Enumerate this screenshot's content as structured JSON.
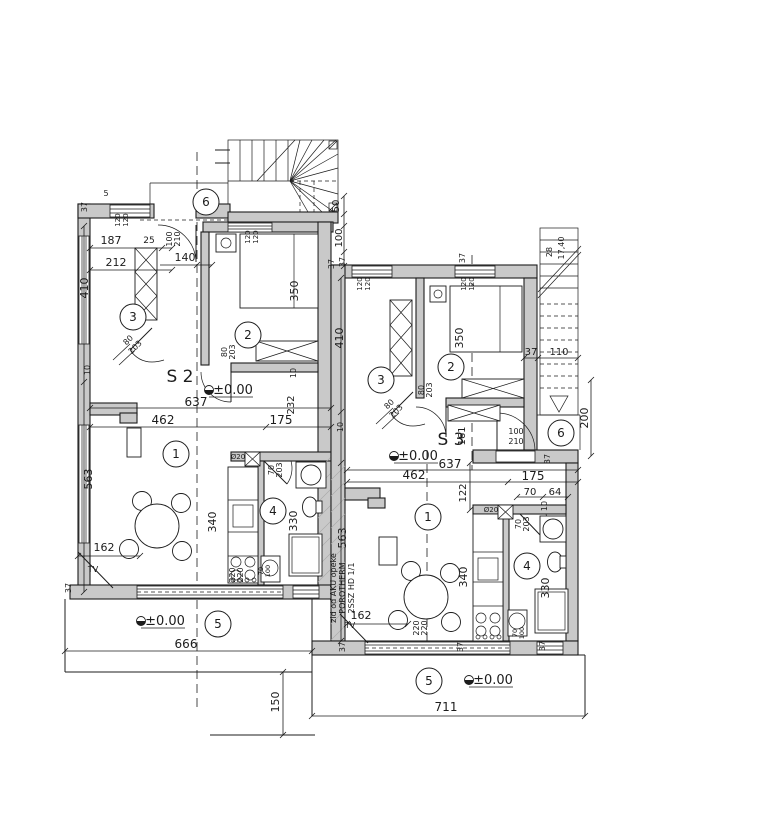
{
  "drawing": {
    "units": {
      "left": "S 2",
      "right": "S 3"
    },
    "elevation": "±0.00",
    "tv": "TV",
    "pipe": "Ø20",
    "rooms": {
      "living": "1",
      "bedroom": "2",
      "hall": "3",
      "bath": "4",
      "terrace": "5",
      "entry": "6"
    },
    "wall_note": {
      "l1": "zid od AKU opeke",
      "l2": "POROTHERM",
      "l3": "2SSZ HD 1/1"
    },
    "dims": {
      "v5": "5",
      "v10": "10",
      "v25": "25",
      "v28": "28",
      "v37": "37",
      "v50": "50",
      "v64": "64",
      "v70": "70",
      "v80": "80",
      "v100": "100",
      "v110": "110",
      "v120": "120",
      "v122": "122",
      "v140": "140",
      "v150": "150",
      "v161": "161",
      "v162": "162",
      "v175": "175",
      "v187": "187",
      "v200": "200",
      "v203": "203",
      "v210": "210",
      "v212": "212",
      "v220": "220",
      "v232": "232",
      "v330": "330",
      "v340": "340",
      "v350": "350",
      "v410": "410",
      "v462": "462",
      "v563": "563",
      "v637": "637",
      "v666": "666",
      "v711": "711",
      "v17_40": "17,40"
    }
  }
}
